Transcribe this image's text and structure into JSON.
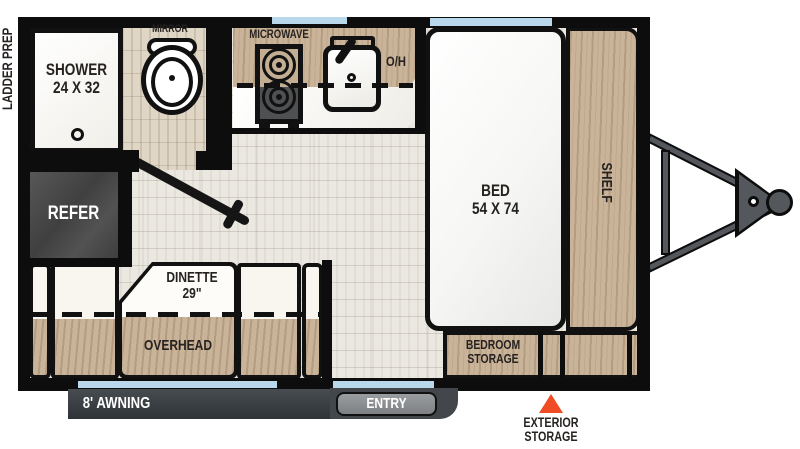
{
  "colors": {
    "wall_black": "#0d0d0d",
    "window_blue": "#b9d8ec",
    "wood_tan": "#c9b399",
    "accent_orange": "#f04c26",
    "refer_gray": "#474747",
    "awning_gray": "#3b4046"
  },
  "exterior": {
    "ladder_prep": "LADDER PREP",
    "awning": "8' AWNING",
    "entry": "ENTRY",
    "exterior_storage": {
      "line1": "EXTERIOR",
      "line2": "STORAGE"
    }
  },
  "bathroom": {
    "shower": {
      "line1": "SHOWER",
      "line2": "24 X 32"
    },
    "mirror": "MIRROR",
    "refer": "REFER"
  },
  "kitchen": {
    "microwave": "MICROWAVE",
    "overhead_cabinet": "O/H"
  },
  "bedroom": {
    "bed": {
      "line1": "BED",
      "line2": "54 X 74"
    },
    "shelf": "SHELF",
    "bedroom_storage": {
      "line1": "BEDROOM",
      "line2": "STORAGE"
    }
  },
  "dinette": {
    "label_line1": "DINETTE",
    "label_line2": "29\"",
    "overhead": "OVERHEAD"
  }
}
